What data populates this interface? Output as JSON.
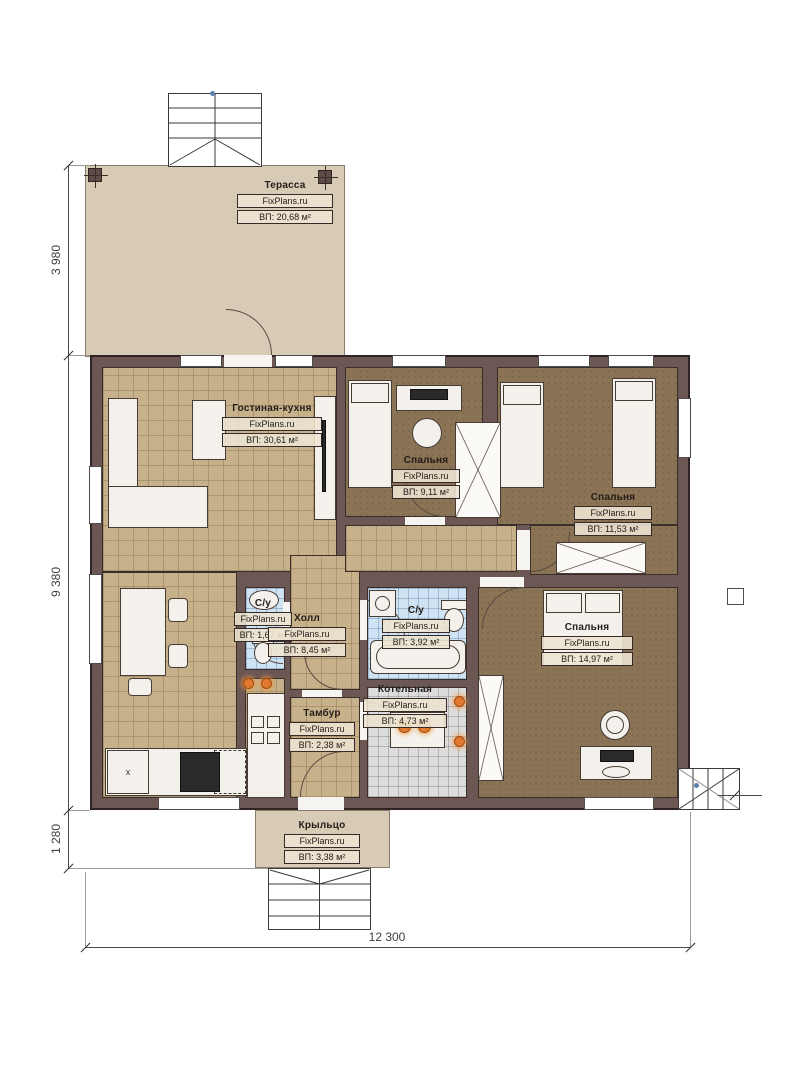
{
  "brand": "FixPlans.ru",
  "rooms": {
    "terrace": {
      "name": "Терасса",
      "brand": "FixPlans.ru",
      "area": "ВП: 20,68 м²"
    },
    "living": {
      "name": "Гостиная-кухня",
      "brand": "FixPlans.ru",
      "area": "ВП: 30,61 м²"
    },
    "bedroom1": {
      "name": "Спальня",
      "brand": "FixPlans.ru",
      "area": "ВП: 9,11 м²"
    },
    "bedroom2": {
      "name": "Спальня",
      "brand": "FixPlans.ru",
      "area": "ВП: 11,53 м²"
    },
    "bedroom3": {
      "name": "Спальня",
      "brand": "FixPlans.ru",
      "area": "ВП: 14,97 м²"
    },
    "hall": {
      "name": "Холл",
      "brand": "FixPlans.ru",
      "area": "ВП: 8,45 м²"
    },
    "wc_small": {
      "name": "С/у",
      "brand": "FixPlans.ru",
      "area": "ВП: 1,67 м²"
    },
    "wc_main": {
      "name": "С/у",
      "brand": "FixPlans.ru",
      "area": "ВП: 3,92 м²"
    },
    "boiler": {
      "name": "Котельная",
      "brand": "FixPlans.ru",
      "area": "ВП: 4,73 м²"
    },
    "tambour": {
      "name": "Тамбур",
      "brand": "FixPlans.ru",
      "area": "ВП: 2,38 м²"
    },
    "porch": {
      "name": "Крыльцо",
      "brand": "FixPlans.ru",
      "area": "ВП: 3,38 м²"
    }
  },
  "dimensions": {
    "left_top": "3 980",
    "left_middle": "9 380",
    "left_bottom": "1 280",
    "bottom_total": "12 300"
  },
  "misc": {
    "dishwasher_marker": "x"
  },
  "colors": {
    "wall": "#6c5755",
    "floor_tan": "#c6b18b",
    "floor_brown": "#8b7356",
    "tile_blue": "#cfe3f2",
    "tile_gray": "#dcdcdc",
    "terrace_beige": "#d8cbb5",
    "sconce_orange": "#e07a30"
  }
}
